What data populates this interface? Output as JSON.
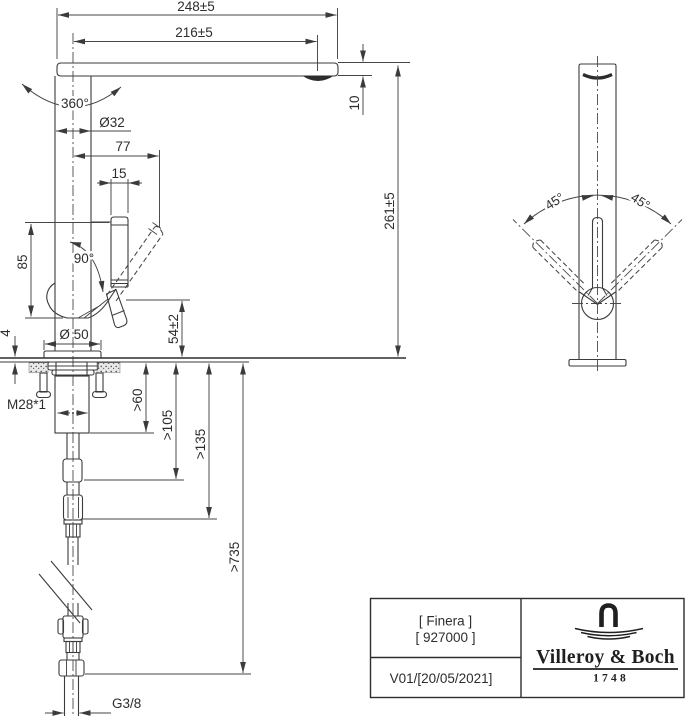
{
  "dims": {
    "total_depth": "248±5",
    "spout_reach": "216±5",
    "swivel_range": "360°",
    "body_diameter": "Ø32",
    "handle_depth": "77",
    "handle_width": "15",
    "spout_thickness": "10",
    "spout_height": "261±5",
    "handle_zone_height": "85",
    "handle_open_angle": "90°",
    "deck_min_thickness": "4",
    "base_diameter": "Ø 50",
    "outlet_clearance": "54±2",
    "shank_thread": "M28*1",
    "clearance_under_deck": ">60",
    "clearance_mid": ">105",
    "clearance_low": ">135",
    "hose_clearance": ">735",
    "supply_thread": "G3/8",
    "handle_swing_left": "45°",
    "handle_swing_right": "45°"
  },
  "title_block": {
    "series": "[ Finera ]",
    "article": "[ 927000 ]",
    "revision": "V01/[20/05/2021]",
    "brand": "Villeroy & Boch",
    "brand_established": "1748"
  }
}
